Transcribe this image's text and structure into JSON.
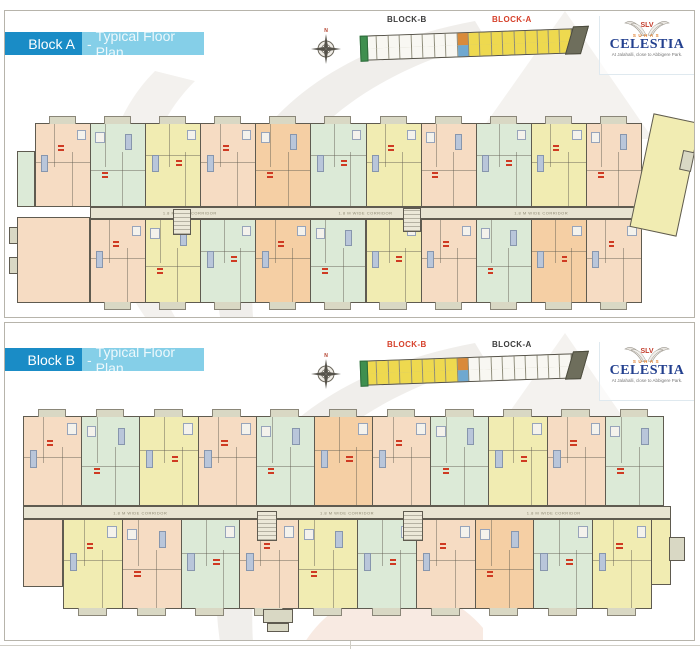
{
  "branding": {
    "slv": "SLV",
    "name_top": "SUHAS",
    "name": "CELESTIA",
    "tagline": "At Jalahalli, close to Abbigere Park."
  },
  "colors": {
    "header_dark": "#1a8cc6",
    "header_light": "#85cfe8",
    "peach": "#f6dcc3",
    "green": "#dcead7",
    "yellow": "#f1ecb2",
    "orange": "#f5cfa4",
    "tab": "#d9d8c4",
    "corridor": "#e8e4d2",
    "kp_yellow": "#eed94f",
    "kp_white": "#f8f7f2",
    "kp_orange": "#d98a3a",
    "kp_blue": "#6fa8d0",
    "label_red": "#d6402a",
    "label_dark": "#3c3c3c"
  },
  "panels": [
    {
      "header": {
        "block": "Block A",
        "separator": "-",
        "title": "Typical Floor Plan"
      },
      "compass": {
        "n": "N"
      },
      "keyplan": {
        "block_b": "BLOCK-B",
        "block_a": "BLOCK-A",
        "active": "A",
        "b_count": 8,
        "a_count": 9
      },
      "corridor_label": "1.8 M WIDE CORRIDOR",
      "plan": {
        "top": {
          "x": 30,
          "y": 112,
          "w": 606,
          "h": 84,
          "units": [
            "peach",
            "green",
            "yellow",
            "peach",
            "orange",
            "green",
            "yellow",
            "peach",
            "green",
            "yellow",
            "peach"
          ]
        },
        "bottom": {
          "x": 85,
          "y": 208,
          "w": 551,
          "h": 84,
          "units": [
            "peach",
            "yellow",
            "green",
            "orange",
            "green",
            "yellow",
            "peach",
            "green",
            "orange",
            "peach"
          ]
        },
        "corridor": {
          "x": 85,
          "y": 196,
          "w": 551,
          "h": 12
        },
        "extras": [
          {
            "x": 12,
            "y": 206,
            "w": 73,
            "h": 86,
            "c": "peach"
          },
          {
            "x": 12,
            "y": 140,
            "w": 18,
            "h": 56,
            "c": "green"
          },
          {
            "x": 4,
            "y": 216,
            "w": 9,
            "h": 17,
            "c": "tab"
          },
          {
            "x": 4,
            "y": 246,
            "w": 9,
            "h": 17,
            "c": "tab"
          },
          {
            "x": 168,
            "y": 198,
            "w": 18,
            "h": 26,
            "hatch": true
          },
          {
            "x": 398,
            "y": 197,
            "w": 18,
            "h": 24,
            "hatch": true
          },
          {
            "x": 636,
            "y": 106,
            "w": 48,
            "h": 116,
            "c": "yellow",
            "rot": 12
          },
          {
            "x": 676,
            "y": 140,
            "w": 12,
            "h": 20,
            "c": "tab",
            "rot": 12
          }
        ]
      }
    },
    {
      "header": {
        "block": "Block B",
        "separator": "-",
        "title": "Typical Floor Plan"
      },
      "compass": {
        "n": "N"
      },
      "keyplan": {
        "block_b": "BLOCK-B",
        "block_a": "BLOCK-A",
        "active": "B",
        "b_count": 8,
        "a_count": 9
      },
      "corridor_label": "1.8 M WIDE CORRIDOR",
      "plan": {
        "top": {
          "x": 18,
          "y": 93,
          "w": 640,
          "h": 90,
          "units": [
            "peach",
            "green",
            "yellow",
            "peach",
            "green",
            "orange",
            "peach",
            "green",
            "yellow",
            "peach",
            "green"
          ]
        },
        "bottom": {
          "x": 58,
          "y": 196,
          "w": 588,
          "h": 90,
          "units": [
            "yellow",
            "peach",
            "green",
            "peach",
            "yellow",
            "green",
            "peach",
            "orange",
            "green",
            "yellow"
          ]
        },
        "corridor": {
          "x": 18,
          "y": 183,
          "w": 648,
          "h": 13
        },
        "extras": [
          {
            "x": 18,
            "y": 196,
            "w": 40,
            "h": 68,
            "c": "peach"
          },
          {
            "x": 252,
            "y": 188,
            "w": 20,
            "h": 30,
            "hatch": true
          },
          {
            "x": 398,
            "y": 188,
            "w": 20,
            "h": 30,
            "hatch": true
          },
          {
            "x": 258,
            "y": 286,
            "w": 30,
            "h": 14,
            "c": "tab"
          },
          {
            "x": 262,
            "y": 300,
            "w": 22,
            "h": 9,
            "c": "tab"
          },
          {
            "x": 646,
            "y": 196,
            "w": 20,
            "h": 66,
            "c": "yellow"
          },
          {
            "x": 664,
            "y": 214,
            "w": 16,
            "h": 24,
            "c": "tab"
          }
        ]
      }
    }
  ]
}
